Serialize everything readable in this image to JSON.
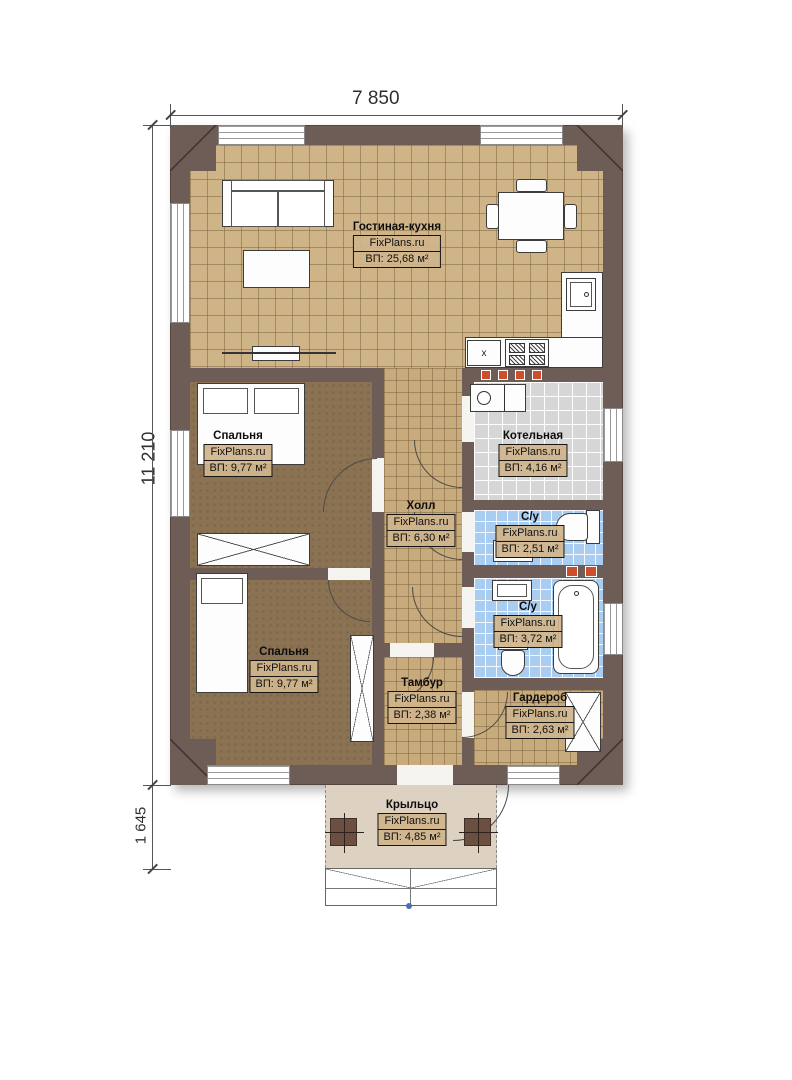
{
  "dimensions": {
    "top_width": "7 850",
    "left_height": "11 210",
    "porch_height": "1 645"
  },
  "brand": "FixPlans.ru",
  "rooms": [
    {
      "id": "living-kitchen",
      "name": "Гостиная-кухня",
      "brand": "FixPlans.ru",
      "area": "ВП: 25,68 м²"
    },
    {
      "id": "bedroom-top",
      "name": "Спальня",
      "brand": "FixPlans.ru",
      "area": "ВП: 9,77 м²"
    },
    {
      "id": "boiler-room",
      "name": "Котельная",
      "brand": "FixPlans.ru",
      "area": "ВП: 4,16 м²"
    },
    {
      "id": "hall",
      "name": "Холл",
      "brand": "FixPlans.ru",
      "area": "ВП: 6,30 м²"
    },
    {
      "id": "bathroom-1",
      "name": "С/у",
      "brand": "FixPlans.ru",
      "area": "ВП: 2,51 м²"
    },
    {
      "id": "bathroom-2",
      "name": "С/у",
      "brand": "FixPlans.ru",
      "area": "ВП: 3,72 м²"
    },
    {
      "id": "bedroom-bottom",
      "name": "Спальня",
      "brand": "FixPlans.ru",
      "area": "ВП: 9,77 м²"
    },
    {
      "id": "vestibule",
      "name": "Тамбур",
      "brand": "FixPlans.ru",
      "area": "ВП: 2,38 м²"
    },
    {
      "id": "wardrobe-room",
      "name": "Гардероб",
      "brand": "FixPlans.ru",
      "area": "ВП: 2,63 м²"
    },
    {
      "id": "porch",
      "name": "Крыльцо",
      "brand": "FixPlans.ru",
      "area": "ВП: 4,85 м²"
    }
  ],
  "kitchen": {
    "sink_mark": "x"
  },
  "colors": {
    "wall": "#6e5c57",
    "floor_tan": "#cfb488",
    "floor_brown": "#8b7253",
    "floor_gray": "#d6d6d6",
    "floor_blue": "#a9cdf0",
    "porch": "#ddd2c1",
    "vent_orange": "#cc4f2b"
  }
}
